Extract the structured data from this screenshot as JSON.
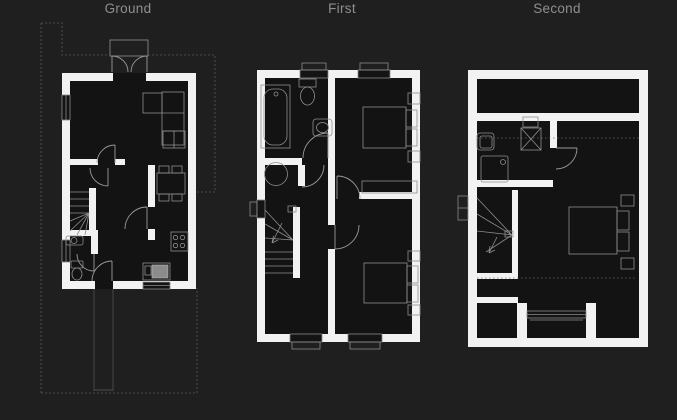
{
  "view": {
    "title": "Floor plans viewer",
    "width": 677,
    "height": 420
  },
  "floors": [
    {
      "id": "ground",
      "label": "Ground",
      "features": [
        "living-room",
        "hall",
        "stairs",
        "wc",
        "kitchen-dining",
        "french-doors",
        "porch-canopy",
        "front-door",
        "garden-path",
        "site-boundary"
      ]
    },
    {
      "id": "first",
      "label": "First",
      "features": [
        "bathroom",
        "airing-cupboard",
        "landing",
        "stairs",
        "bedroom-1",
        "bedroom-2",
        "windows"
      ]
    },
    {
      "id": "second",
      "label": "Second",
      "features": [
        "eaves-storage",
        "ensuite-shower-room",
        "stairs",
        "bedroom-3",
        "dormer-window",
        "reduced-headroom-lines"
      ]
    }
  ],
  "colors": {
    "background": "#1f1f1f",
    "plan_interior": "#131313",
    "wall": "#f2f2f2",
    "linework": "#8f8f8f",
    "door": "#9a9a9a",
    "site_boundary": "#585858",
    "eaves_dotted": "#6e6e6e",
    "label_text": "#8f8f8f",
    "sink_fill": "#8c8c8c"
  }
}
